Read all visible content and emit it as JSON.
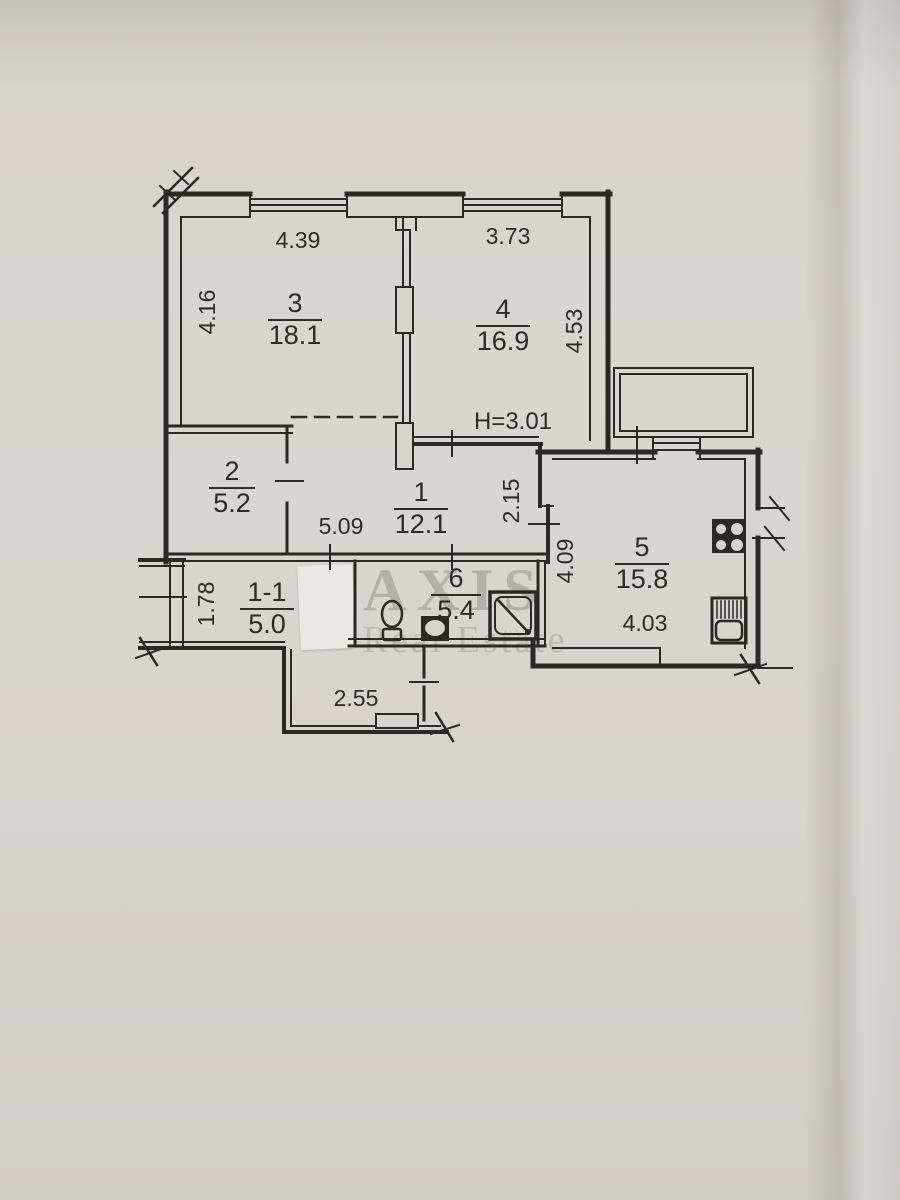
{
  "watermark": {
    "title": "AXIS",
    "subtitle": "Real Estate"
  },
  "ceiling_height": "H=3.01",
  "rooms": [
    {
      "number": "3",
      "area": "18.1"
    },
    {
      "number": "4",
      "area": "16.9"
    },
    {
      "number": "2",
      "area": "5.2"
    },
    {
      "number": "1",
      "area": "12.1"
    },
    {
      "number": "1-1",
      "area": "5.0"
    },
    {
      "number": "6",
      "area": "5.4"
    },
    {
      "number": "5",
      "area": "15.8"
    }
  ],
  "dimensions": {
    "room3_width": "4.39",
    "room3_depth": "4.16",
    "room4_width": "3.73",
    "room4_depth": "4.53",
    "hall_width": "5.09",
    "hall_depth": "2.15",
    "corridor_depth": "1.78",
    "kitchen_depth": "4.09",
    "kitchen_width": "4.03",
    "entry_width": "2.55"
  },
  "colors": {
    "paper": "#d7d4cc",
    "ink": "#2b2924",
    "watermark_gray": "#7d7a72"
  },
  "fixtures": [
    "stove-icon",
    "kitchen-sink-icon",
    "shower-icon",
    "toilet-icon",
    "washbasin-icon"
  ]
}
